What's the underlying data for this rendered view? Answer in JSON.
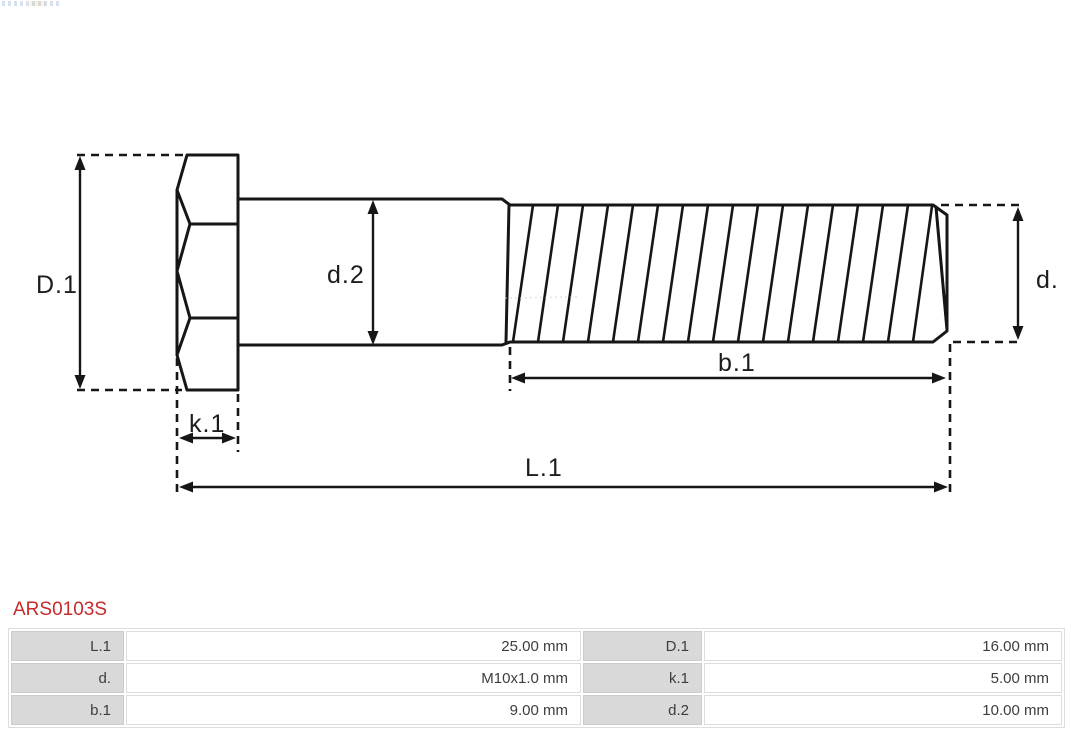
{
  "part": {
    "number": "ARS0103S"
  },
  "drawing": {
    "labels": {
      "D1": "D.1",
      "d2": "d.2",
      "d": "d.",
      "b1": "b.1",
      "k1": "k.1",
      "L1": "L.1"
    }
  },
  "spec_table": {
    "rows": [
      {
        "cells": [
          "L.1",
          "25.00 mm",
          "D.1",
          "16.00 mm"
        ]
      },
      {
        "cells": [
          "d.",
          "M10x1.0 mm",
          "k.1",
          "5.00 mm"
        ]
      },
      {
        "cells": [
          "b.1",
          "9.00 mm",
          "d.2",
          "10.00 mm"
        ]
      }
    ]
  },
  "colors": {
    "accent_red": "#c62a2a",
    "line_black": "#161616",
    "table_label_bg": "#d9d9d9",
    "table_border": "#dedede"
  }
}
